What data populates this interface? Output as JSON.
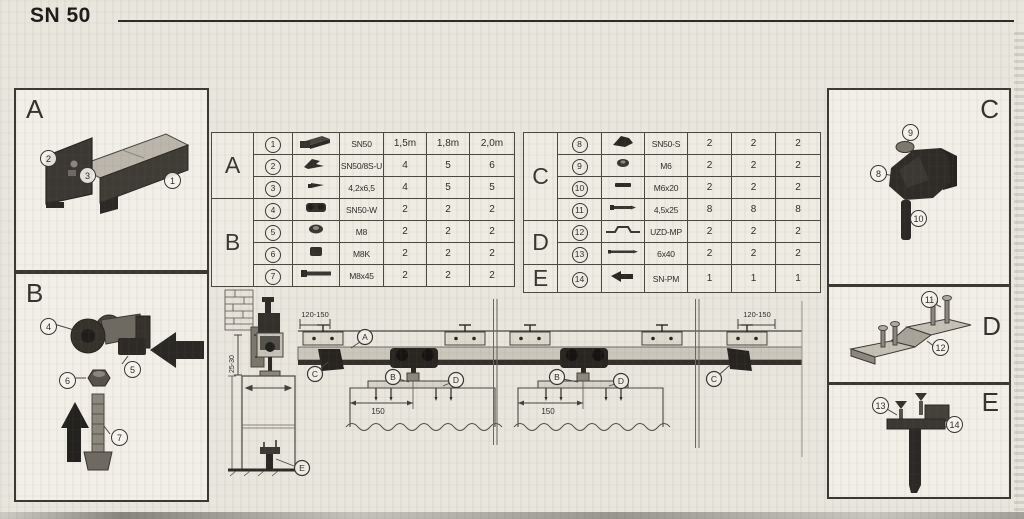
{
  "header": {
    "title": "SN 50"
  },
  "panels": {
    "a": {
      "label": "A",
      "callouts": [
        "2",
        "3",
        "1"
      ]
    },
    "b": {
      "label": "B",
      "callouts": [
        "4",
        "5",
        "6",
        "7"
      ]
    },
    "c": {
      "label": "C",
      "callouts": [
        "9",
        "8",
        "10"
      ]
    },
    "d": {
      "label": "D",
      "callouts": [
        "11",
        "12"
      ]
    },
    "e": {
      "label": "E",
      "callouts": [
        "13",
        "14"
      ]
    }
  },
  "table_left": {
    "section_a": "A",
    "section_b": "B",
    "rows": [
      {
        "num": "1",
        "icon": "rail-profile",
        "name": "SN50",
        "c1": "1,5m",
        "c2": "1,8m",
        "c3": "2,0m"
      },
      {
        "num": "2",
        "icon": "mounting-clip",
        "name": "SN50/8S-U",
        "c1": "4",
        "c2": "5",
        "c3": "6"
      },
      {
        "num": "3",
        "icon": "screw-small",
        "name": "4,2x6,5",
        "c1": "4",
        "c2": "5",
        "c3": "5"
      },
      {
        "num": "4",
        "icon": "roller-carriage",
        "name": "SN50-W",
        "c1": "2",
        "c2": "2",
        "c3": "2"
      },
      {
        "num": "5",
        "icon": "nut",
        "name": "M8",
        "c1": "2",
        "c2": "2",
        "c3": "2"
      },
      {
        "num": "6",
        "icon": "cap-nut",
        "name": "M8K",
        "c1": "2",
        "c2": "2",
        "c3": "2"
      },
      {
        "num": "7",
        "icon": "hex-bolt",
        "name": "M8x45",
        "c1": "2",
        "c2": "2",
        "c3": "2"
      }
    ]
  },
  "table_right": {
    "section_c": "C",
    "section_d": "D",
    "section_e": "E",
    "rows": [
      {
        "num": "8",
        "icon": "stopper",
        "name": "SN50-S",
        "c1": "2",
        "c2": "2",
        "c3": "2"
      },
      {
        "num": "9",
        "icon": "nut",
        "name": "M6",
        "c1": "2",
        "c2": "2",
        "c3": "2"
      },
      {
        "num": "10",
        "icon": "stud",
        "name": "M6x20",
        "c1": "2",
        "c2": "2",
        "c3": "2"
      },
      {
        "num": "11",
        "icon": "screw",
        "name": "4,5x25",
        "c1": "8",
        "c2": "8",
        "c3": "8"
      },
      {
        "num": "12",
        "icon": "guide-profile",
        "name": "UZD-MP",
        "c1": "2",
        "c2": "2",
        "c3": "2"
      },
      {
        "num": "13",
        "icon": "screw-long",
        "name": "6x40",
        "c1": "2",
        "c2": "2",
        "c3": "2"
      },
      {
        "num": "14",
        "icon": "floor-guide",
        "name": "SN-PM",
        "c1": "1",
        "c2": "1",
        "c3": "1"
      }
    ]
  },
  "drawing": {
    "dim_overhang_left": "120-150",
    "dim_overhang_right": "120-150",
    "dim_hanger_door1": "150",
    "dim_hanger_door2": "150",
    "dim_wall_clearance": "25-30",
    "callouts": {
      "a": "A",
      "c_left": "C",
      "b1": "B",
      "d1": "D",
      "b2": "B",
      "d2": "D",
      "c_right": "C",
      "e": "E"
    }
  }
}
